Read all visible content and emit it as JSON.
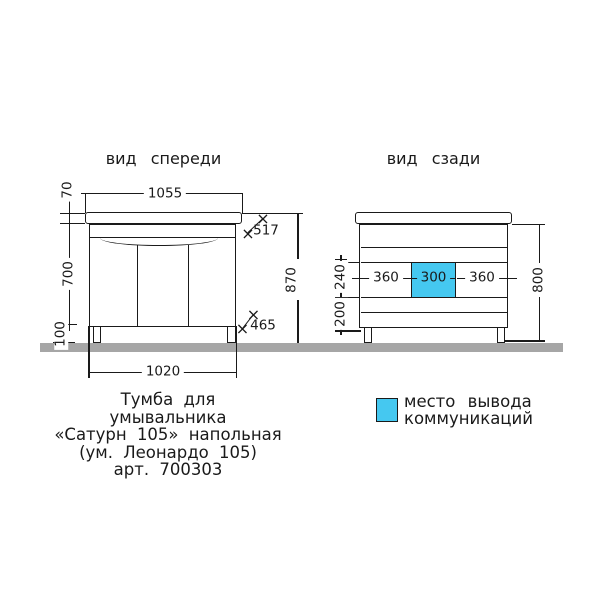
{
  "drawing": {
    "front_view": {
      "title": "вид спереди",
      "dimensions": {
        "countertop_width": "1055",
        "countertop_thickness": "70",
        "body_height": "700",
        "leg_height": "100",
        "total_height": "870",
        "countertop_depth": "517",
        "body_depth": "465",
        "body_width": "1020"
      }
    },
    "back_view": {
      "title": "вид сзади",
      "dimensions": {
        "left_offset": "360",
        "outlet_width": "300",
        "right_offset": "360",
        "outlet_upper": "240",
        "outlet_lower": "200",
        "back_height": "800"
      }
    },
    "legend": {
      "line1": "место вывода",
      "line2": "коммуникаций"
    },
    "caption": {
      "line1": "Тумба для",
      "line2": "умывальника",
      "line3": "«Сатурн 105» напольная",
      "line4": "(ум. Леонардо 105)",
      "line5": "арт. 700303"
    },
    "symbols": {
      "x_mark": "×"
    },
    "colors": {
      "outlet_highlight": "#45c8f0",
      "floor": "#a6a6a6",
      "line": "#1a1a1a"
    }
  }
}
